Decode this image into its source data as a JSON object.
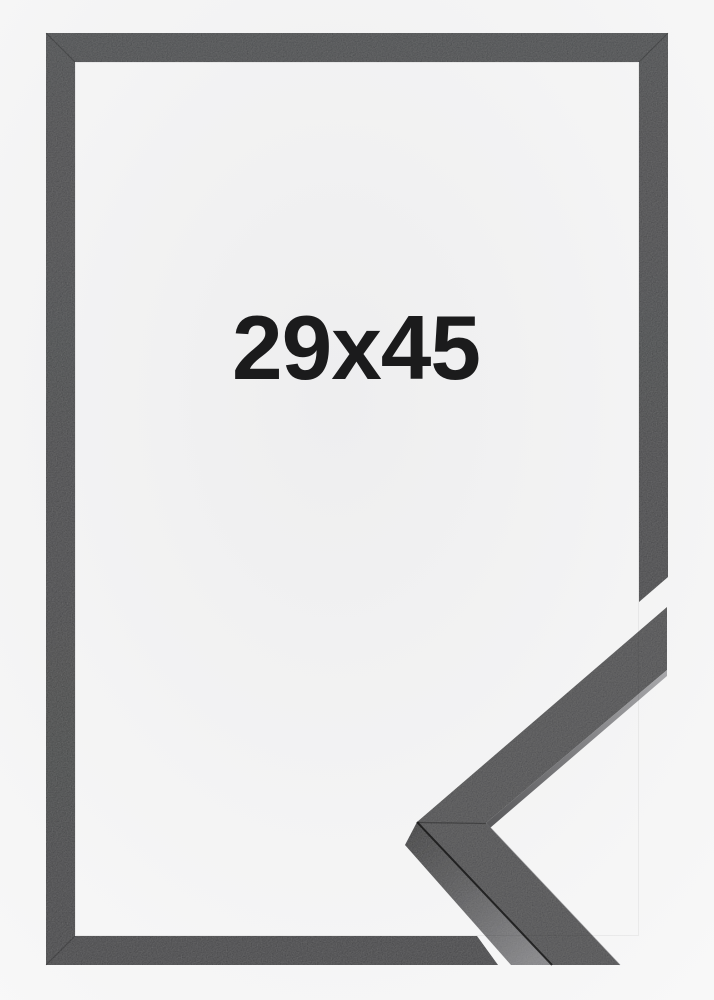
{
  "image": {
    "size_label": "29x45"
  },
  "colors": {
    "backdrop_center": "#eeeeef",
    "backdrop_edge": "#f8f8f8",
    "frame_top": "#36373a",
    "frame_bottom": "#2d2e30",
    "sample_face": "#3a3b3c",
    "side_near": "#232325",
    "side_far": "#7d7d80",
    "sliver_near": "#59595b",
    "sliver_far": "#a8a8ab",
    "edge_dark": "#151515",
    "seam": "#000000",
    "label_text": "#1b1b1c"
  }
}
